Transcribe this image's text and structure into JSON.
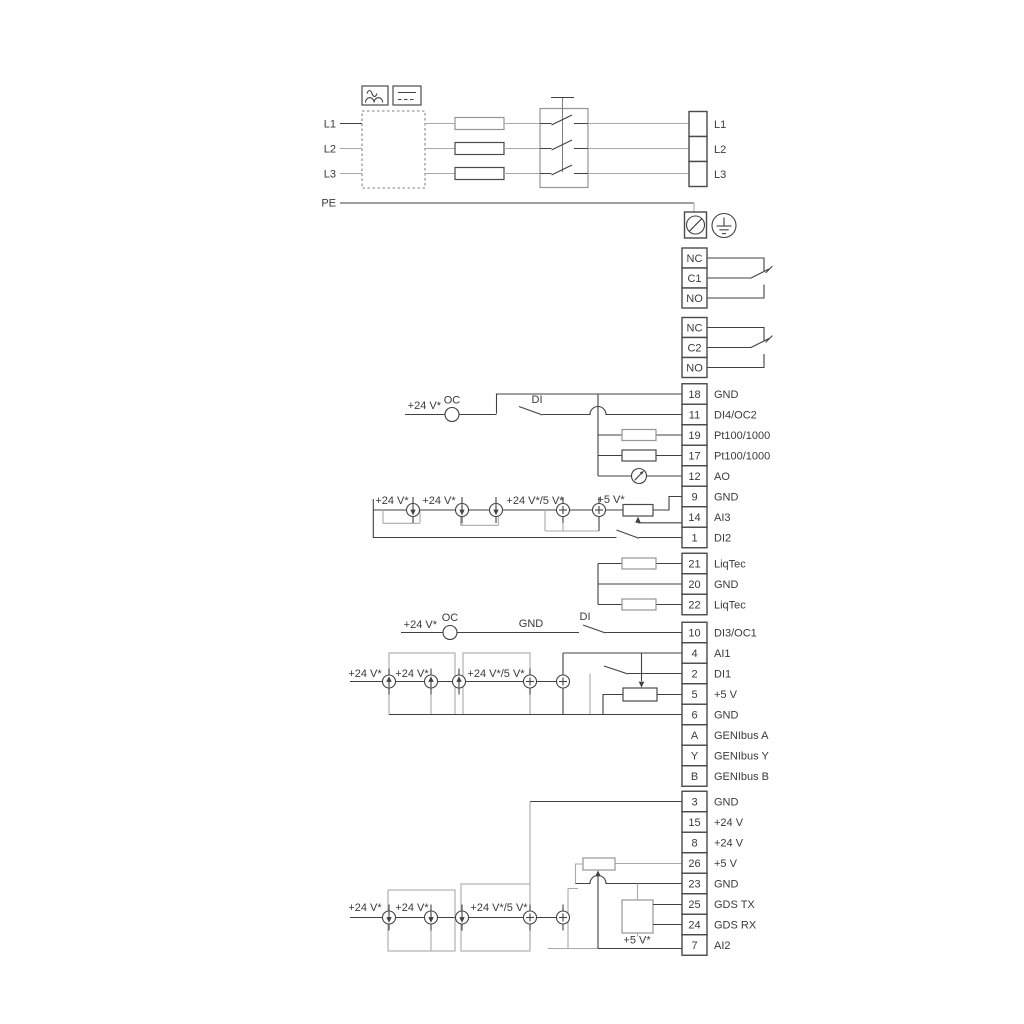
{
  "mains": {
    "inputs": [
      "L1",
      "L2",
      "L3"
    ],
    "pe": "PE"
  },
  "annotations": {
    "v24": "+24 V*",
    "v24_5": "+24 V*/5 V*",
    "v5": "+5 V*",
    "oc": "OC",
    "di": "DI",
    "gnd": "GND"
  },
  "icons": {
    "ac_symbol": "ac-sine",
    "dc_symbol": "dc-line",
    "pe_terminal": "crossed-circle",
    "earth": "protective-earth",
    "current_source_down": "circle-arrow-down",
    "current_source_up": "circle-arrow-up",
    "current_source_plus": "circle-plus",
    "analog_output_meter": "dial-arrow"
  },
  "colors": {
    "wire_black": "#414143",
    "wire_gray": "#a7a9ac",
    "background": "#ffffff"
  },
  "terminal_blocks": {
    "mains_output": {
      "rows": [
        {
          "no": "",
          "label": "L1"
        },
        {
          "no": "",
          "label": "L2"
        },
        {
          "no": "",
          "label": "L3"
        }
      ]
    },
    "relay1": {
      "rows": [
        {
          "no": "NC",
          "label": ""
        },
        {
          "no": "C1",
          "label": ""
        },
        {
          "no": "NO",
          "label": ""
        }
      ]
    },
    "relay2": {
      "rows": [
        {
          "no": "NC",
          "label": ""
        },
        {
          "no": "C2",
          "label": ""
        },
        {
          "no": "NO",
          "label": ""
        }
      ]
    },
    "io1": {
      "rows": [
        {
          "no": "18",
          "label": "GND"
        },
        {
          "no": "11",
          "label": "DI4/OC2"
        },
        {
          "no": "19",
          "label": "Pt100/1000"
        },
        {
          "no": "17",
          "label": "Pt100/1000"
        },
        {
          "no": "12",
          "label": "AO"
        },
        {
          "no": "9",
          "label": "GND"
        },
        {
          "no": "14",
          "label": "AI3"
        },
        {
          "no": "1",
          "label": "DI2"
        }
      ]
    },
    "liqtec": {
      "rows": [
        {
          "no": "21",
          "label": "LiqTec"
        },
        {
          "no": "20",
          "label": "GND"
        },
        {
          "no": "22",
          "label": "LiqTec"
        }
      ]
    },
    "io2": {
      "rows": [
        {
          "no": "10",
          "label": "DI3/OC1"
        },
        {
          "no": "4",
          "label": "AI1"
        },
        {
          "no": "2",
          "label": "DI1"
        },
        {
          "no": "5",
          "label": "+5 V"
        },
        {
          "no": "6",
          "label": "GND"
        },
        {
          "no": "A",
          "label": "GENIbus A"
        },
        {
          "no": "Y",
          "label": "GENIbus Y"
        },
        {
          "no": "B",
          "label": "GENIbus B"
        }
      ]
    },
    "io3": {
      "rows": [
        {
          "no": "3",
          "label": "GND"
        },
        {
          "no": "15",
          "label": "+24 V"
        },
        {
          "no": "8",
          "label": "+24 V"
        },
        {
          "no": "26",
          "label": "+5 V"
        },
        {
          "no": "23",
          "label": "GND"
        },
        {
          "no": "25",
          "label": "GDS TX"
        },
        {
          "no": "24",
          "label": "GDS RX"
        },
        {
          "no": "7",
          "label": "AI2"
        }
      ]
    }
  }
}
